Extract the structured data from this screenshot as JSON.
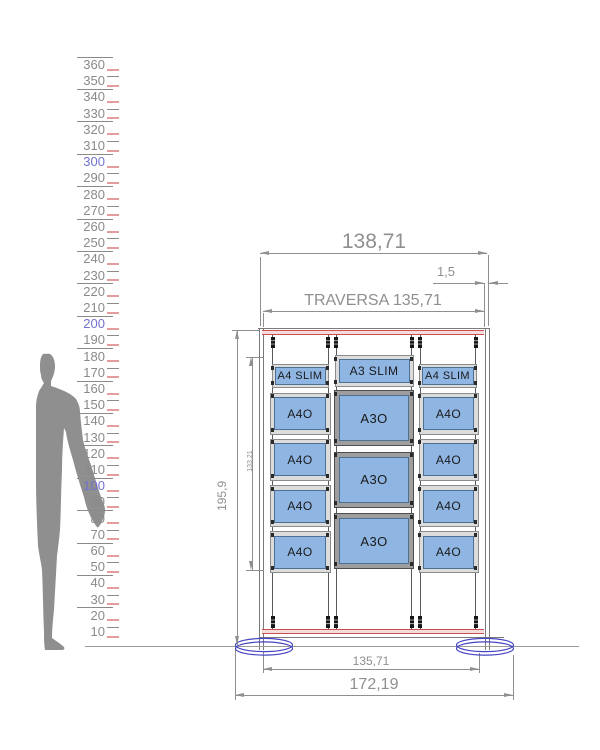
{
  "colors": {
    "dim": "#8f8f8f",
    "structure": "#7a7a7a",
    "red": "#c85050",
    "red_fill": "#f4dcdc",
    "panel_blue": "#8fb5e3",
    "panel_blue_border": "#4d6f93",
    "frame_light": "#dcdcdc",
    "frame_light_border": "#8c8c8c",
    "frame_dark": "#9e9e9e",
    "frame_dark_border": "#4f4f4f",
    "base_blue": "#4444c4",
    "silhouette": "#8f8f8f",
    "ruler_num": "#8a8a8a",
    "ruler_num_highlight": "#7272d0",
    "ruler_tick_red": "#e49c9c",
    "ruler_line": "#8a8a8a",
    "cable": "#5a5a5a",
    "label": "#1a1a1a"
  },
  "ruler": {
    "values": [
      360,
      350,
      340,
      330,
      320,
      310,
      300,
      290,
      280,
      270,
      260,
      250,
      240,
      230,
      220,
      210,
      200,
      190,
      180,
      170,
      160,
      150,
      140,
      130,
      120,
      110,
      100,
      90,
      80,
      70,
      60,
      50,
      40,
      30,
      20,
      10
    ],
    "highlighted": [
      300,
      200,
      100
    ]
  },
  "display_unit": {
    "columns": [
      {
        "header": "A4 SLIM",
        "panels": [
          "A4O",
          "A4O",
          "A4O",
          "A4O"
        ]
      },
      {
        "header": "A3 SLIM",
        "panels": [
          "A3O",
          "A3O",
          "A3O"
        ]
      },
      {
        "header": "A4 SLIM",
        "panels": [
          "A4O",
          "A4O",
          "A4O",
          "A4O"
        ]
      }
    ],
    "dimensions": {
      "overall_width": "138,71",
      "edge_gap": "1,5",
      "traversa": "TRAVERSA 135,71",
      "overall_height": "195,9",
      "panel_stack_height": "133,21",
      "base_span": "135,71",
      "base_overall": "172,19"
    }
  }
}
